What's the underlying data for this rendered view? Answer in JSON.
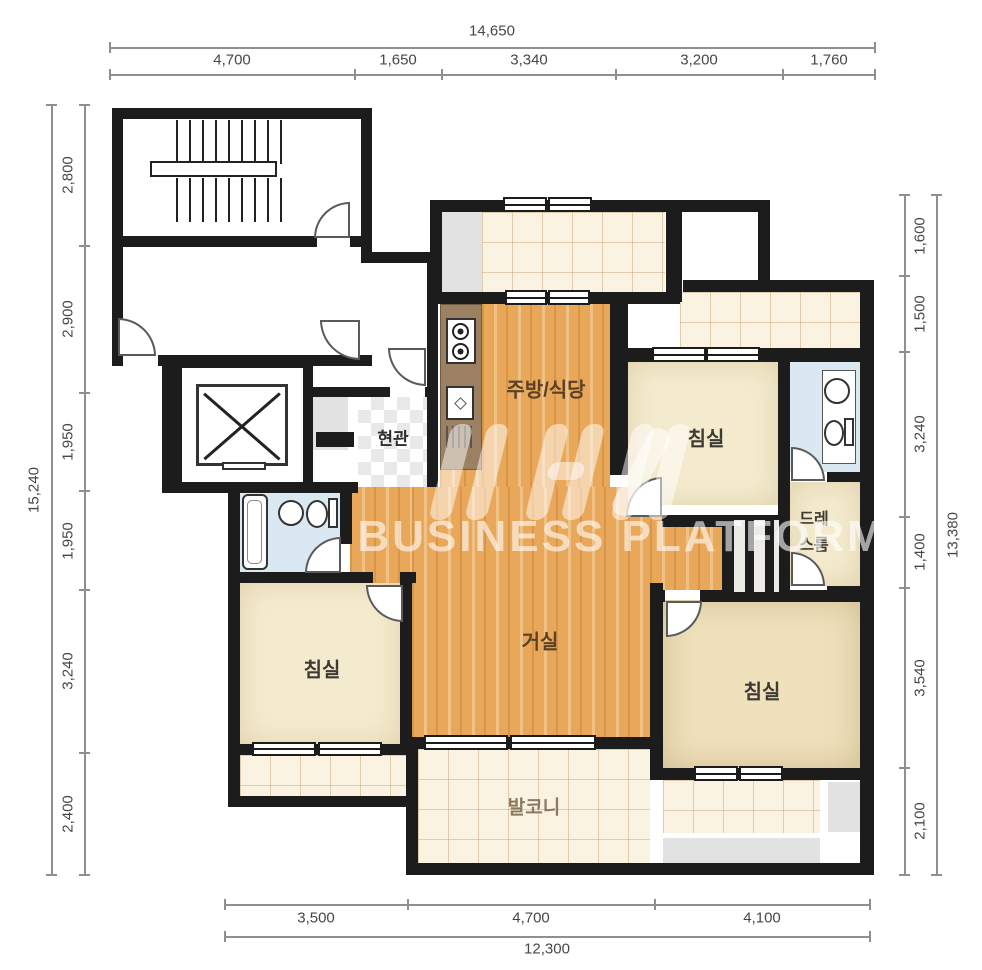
{
  "watermark": {
    "platform_text": "BUSINESS PLATFORM"
  },
  "dimensions": {
    "top": {
      "total": "14,650",
      "segments": [
        "4,700",
        "1,650",
        "3,340",
        "3,200",
        "1,760"
      ]
    },
    "left": {
      "total": "15,240",
      "segments": [
        "2,800",
        "2,900",
        "1,950",
        "1,950",
        "3,240",
        "2,400"
      ]
    },
    "right": {
      "total": "13,380",
      "segments": [
        "1,600",
        "1,500",
        "3,240",
        "1,400",
        "3,540",
        "2,100"
      ]
    },
    "bottom": {
      "total": "12,300",
      "segments": [
        "3,500",
        "4,700",
        "4,100"
      ]
    }
  },
  "rooms": {
    "kitchen_dining": "주방/식당",
    "entrance": "현관",
    "bedroom_top": "침실",
    "bedroom_left": "침실",
    "bedroom_right": "침실",
    "living": "거실",
    "balcony": "발코니",
    "dressroom_line1": "드레",
    "dressroom_line2": "스룸"
  },
  "colors": {
    "wall": "#1c1c1c",
    "wood_floor": "#e9a75a",
    "bedroom_floor": "#f4ebce",
    "balcony_tile": "#fbf3e1",
    "bathroom": "#d9e8f1",
    "counter": "#9c8062",
    "dimension_text": "#474747"
  }
}
